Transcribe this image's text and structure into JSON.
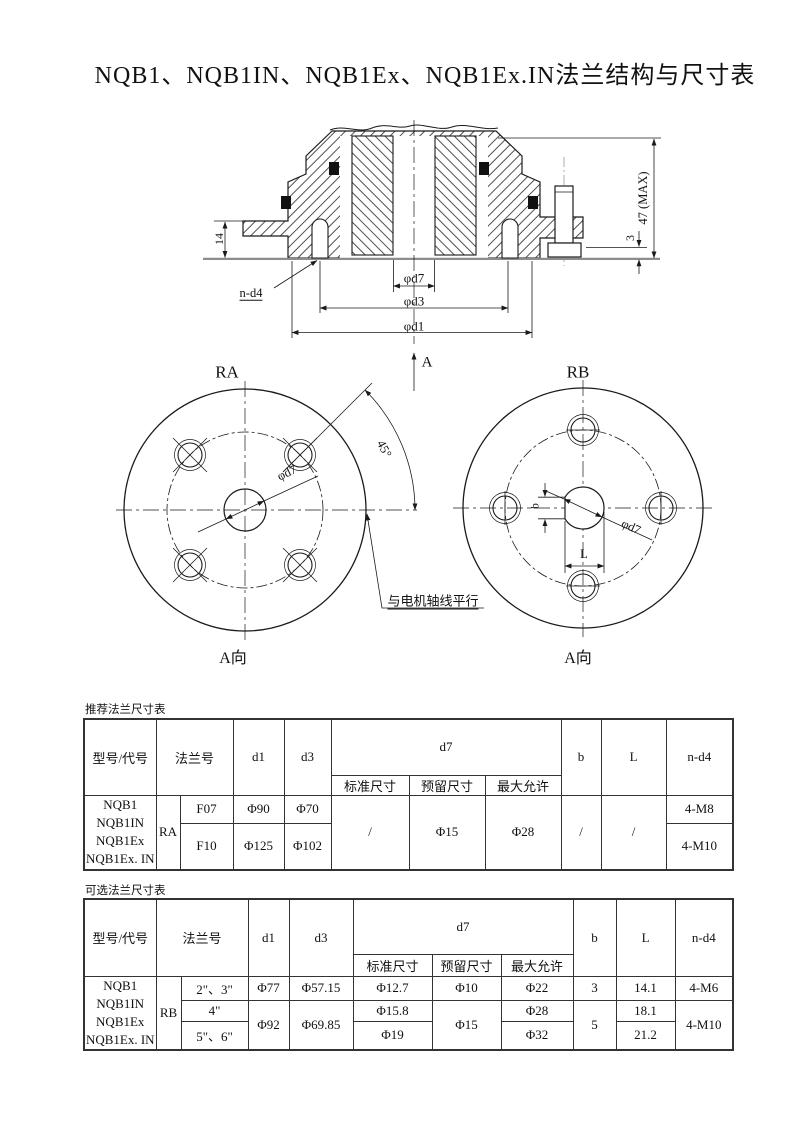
{
  "title": "NQB1、NQB1IN、NQB1Ex、NQB1Ex.IN法兰结构与尺寸表",
  "section": {
    "dim_height_total": "47 (MAX)",
    "dim_plate": "14",
    "dim_gap": "3",
    "bolt_note": "n-d4",
    "dim_bore": "φd7",
    "dim_bolt_circle": "φd3",
    "dim_flange": "φd1",
    "view_arrow": "A"
  },
  "view_ra": {
    "name": "RA",
    "bore_dim": "φd7",
    "angle": "45°",
    "note": "与电机轴线平行",
    "direction": "A向"
  },
  "view_rb": {
    "name": "RB",
    "bore_dim": "φd7",
    "key_width": "b",
    "key_length": "L",
    "direction": "A向"
  },
  "table_recommended": {
    "caption": "推荐法兰尺寸表",
    "headers": {
      "model": "型号/代号",
      "flange": "法兰号",
      "d1": "d1",
      "d3": "d3",
      "d7": "d7",
      "std": "标准尺寸",
      "reserved": "预留尺寸",
      "max": "最大允许",
      "b": "b",
      "l": "L",
      "nd4": "n-d4"
    },
    "models": [
      "NQB1",
      "NQB1IN",
      "NQB1Ex",
      "NQB1Ex. IN"
    ],
    "group": "RA",
    "rows": [
      {
        "flange_no": "F07",
        "d1": "Φ90",
        "d3": "Φ70",
        "nd4": "4-M8"
      },
      {
        "flange_no": "F10",
        "d1": "Φ125",
        "d3": "Φ102",
        "nd4": "4-M10"
      }
    ],
    "merged": {
      "std": "/",
      "reserved": "Φ15",
      "max": "Φ28",
      "b": "/",
      "l": "/"
    }
  },
  "table_optional": {
    "caption": "可选法兰尺寸表",
    "headers": {
      "model": "型号/代号",
      "flange": "法兰号",
      "d1": "d1",
      "d3": "d3",
      "d7": "d7",
      "std": "标准尺寸",
      "reserved": "预留尺寸",
      "max": "最大允许",
      "b": "b",
      "l": "L",
      "nd4": "n-d4"
    },
    "models": [
      "NQB1",
      "NQB1IN",
      "NQB1Ex",
      "NQB1Ex. IN"
    ],
    "group": "RB",
    "rows": [
      {
        "flange_no": "2\"、3\"",
        "d1": "Φ77",
        "d3": "Φ57.15",
        "std": "Φ12.7",
        "reserved": "Φ10",
        "max": "Φ22",
        "b": "3",
        "l": "14.1",
        "nd4": "4-M6"
      },
      {
        "flange_no": "4\"",
        "std": "Φ15.8",
        "l": "18.1"
      },
      {
        "flange_no": "5\"、6\"",
        "std": "Φ19",
        "max_r3": "Φ32",
        "l": "21.2"
      }
    ],
    "row2_max": "Φ28",
    "merged": {
      "d1": "Φ92",
      "d3": "Φ69.85",
      "reserved": "Φ15",
      "b": "5",
      "nd4": "4-M10"
    }
  }
}
